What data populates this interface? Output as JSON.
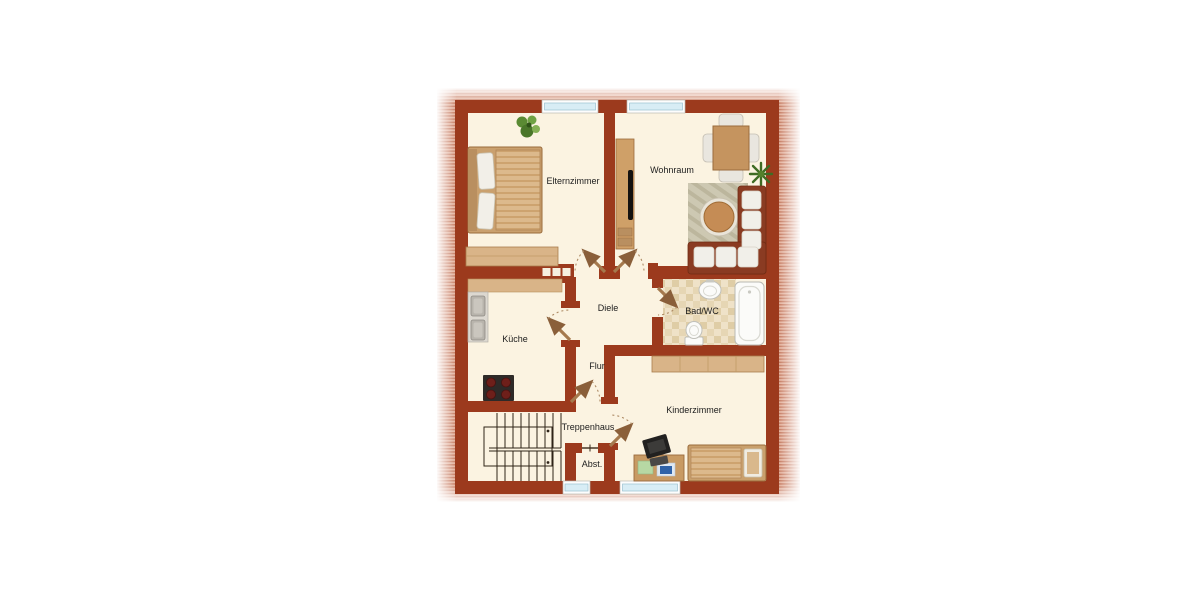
{
  "plan": {
    "rooms": {
      "elternzimmer": {
        "label": "Elternzimmer"
      },
      "wohnraum": {
        "label": "Wohnraum"
      },
      "diele": {
        "label": "Diele"
      },
      "kueche": {
        "label": "Küche"
      },
      "bad_wc": {
        "label": "Bad/WC"
      },
      "flur": {
        "label": "Flur"
      },
      "kinderzimmer": {
        "label": "Kinderzimmer"
      },
      "treppenhaus": {
        "label": "Treppenhaus"
      },
      "abstellraum": {
        "label": "Abst."
      }
    },
    "colors": {
      "wall": "#9c3a1d",
      "floor": "#fbf3e1",
      "band_stripe_dark": "#c4765b",
      "band_stripe_light": "#e3b09b",
      "window_glass": "#d8edf5",
      "wood": "#d9b488",
      "door_leaf": "#a5794d",
      "bath_tile": "#efe2c8"
    },
    "furniture_icons": [
      "potted-plant-icon",
      "double-bed-icon",
      "wardrobe-icon",
      "shelf-tv-icon",
      "dining-table-icon",
      "chair-icon",
      "corner-sofa-icon",
      "coffee-table-icon",
      "rug-icon",
      "kitchen-counter-icon",
      "double-sink-icon",
      "stove-icon",
      "washbasin-icon",
      "toilet-icon",
      "bathtub-icon",
      "staircase-icon",
      "desk-icon",
      "computer-icon",
      "single-bed-icon",
      "glass-block-window-icon",
      "door-swing-icon",
      "window-icon"
    ]
  }
}
